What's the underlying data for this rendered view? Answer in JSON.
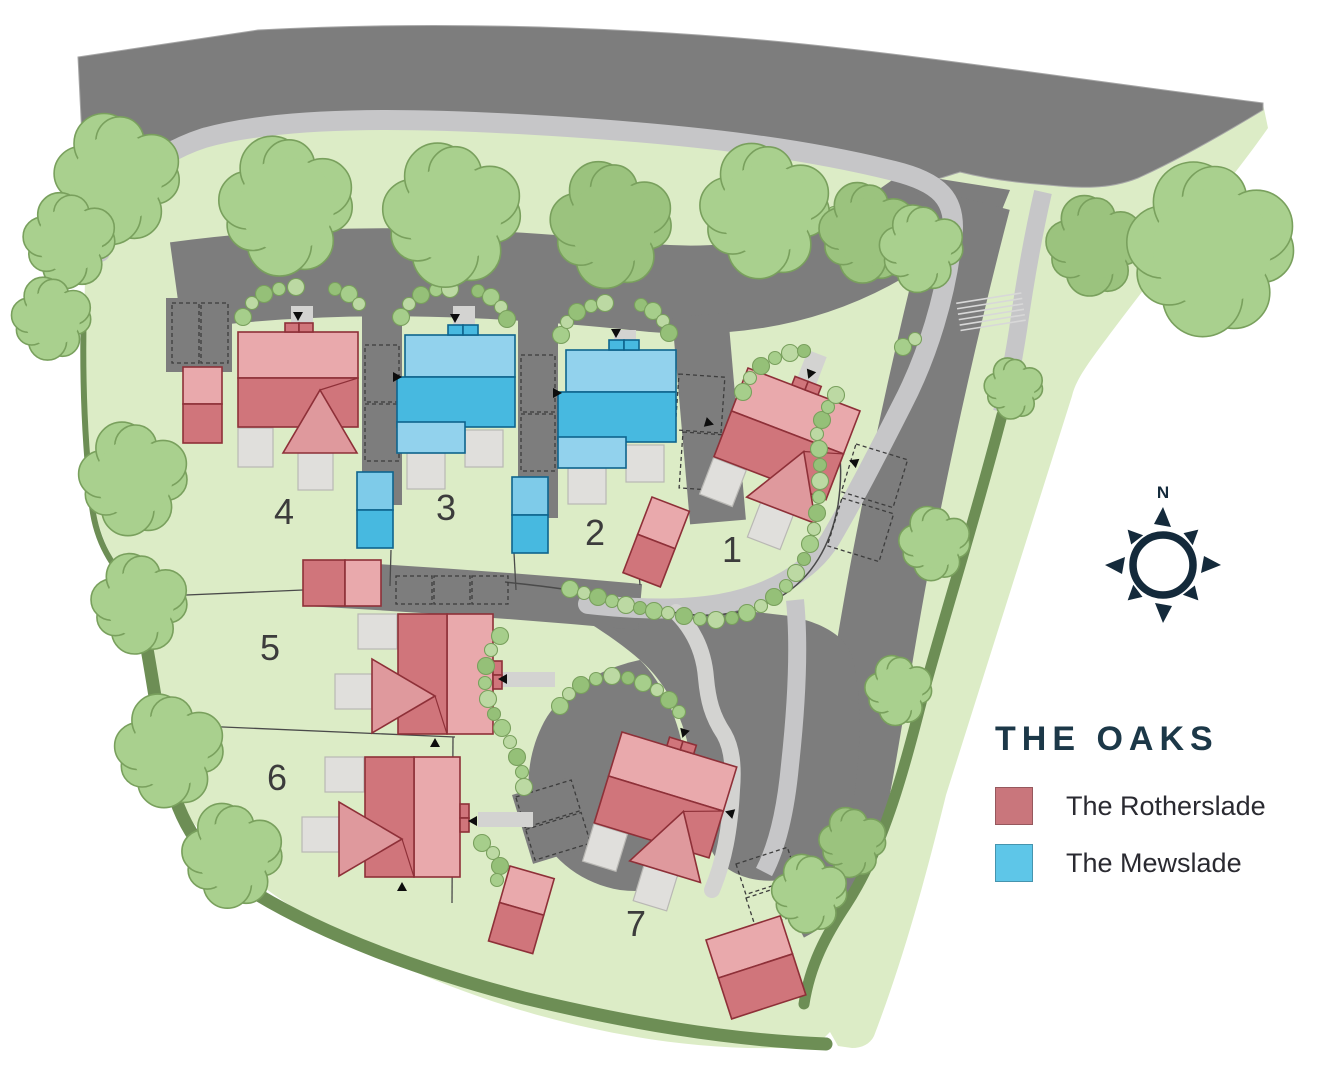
{
  "title": "THE OAKS",
  "legend": {
    "items": [
      {
        "label": "The Rotherslade",
        "color": "#c9767c"
      },
      {
        "label": "The Mewslade",
        "color": "#5ec6e8"
      }
    ]
  },
  "compass": {
    "north_label": "N"
  },
  "plots": [
    {
      "number": "1",
      "type": "The Rotherslade"
    },
    {
      "number": "2",
      "type": "The Mewslade"
    },
    {
      "number": "3",
      "type": "The Mewslade"
    },
    {
      "number": "4",
      "type": "The Rotherslade"
    },
    {
      "number": "5",
      "type": "The Rotherslade"
    },
    {
      "number": "6",
      "type": "The Rotherslade"
    },
    {
      "number": "7",
      "type": "The Rotherslade"
    }
  ],
  "palette": {
    "rotherslade_light": "#e9a9ac",
    "rotherslade_dark": "#d0757b",
    "rotherslade_gable": "#df999d",
    "rotherslade_stroke": "#8e3038",
    "mewslade_light": "#92d2ed",
    "mewslade_dark": "#47b9e0",
    "mewslade_stroke": "#0e648d",
    "grass": "#dcecc6",
    "road": "#7d7d7d",
    "pavement": "#c6c6c8",
    "doorpath": "#d3d3d1",
    "hedge": "#6d8e55",
    "tree_light": "#a9d08e",
    "tree_dark": "#9bc37e",
    "tree_stroke": "#79a05d",
    "patio": "#e0dfdc",
    "title_color": "#1c3848"
  }
}
